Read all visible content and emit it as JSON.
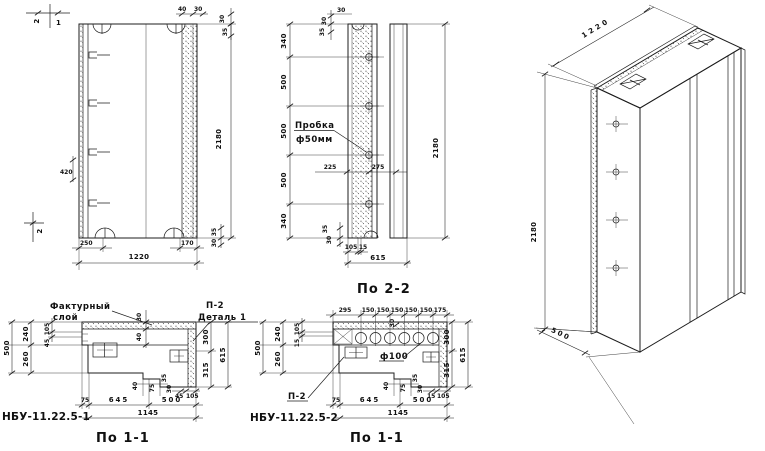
{
  "title": "Рабочий чертёж панели НБУ-11.22.5",
  "elevation": {
    "mark_2_top": "2",
    "mark_1_top": "1",
    "mark_2_bottom": "2",
    "dim_top_40": "40",
    "dim_top_30a": "30",
    "dim_top_30b": "30",
    "dim_top_35": "35",
    "dim_height": "2180",
    "dim_420": "420",
    "dim_250": "250",
    "dim_170": "170",
    "dim_1220": "1220",
    "dim_br_35": "35",
    "dim_br_30": "30"
  },
  "side": {
    "caption": "По 2-2",
    "plug_line1": "Пробка",
    "plug_line2": "ф50мм",
    "dim_top_30": "30",
    "dim_top_30r": "30",
    "dim_top_35": "35",
    "dim_340t": "340",
    "dim_500a": "500",
    "dim_500b": "500",
    "dim_500c": "500",
    "dim_340b": "340",
    "dim_225": "225",
    "dim_275": "275",
    "dim_bot_35": "35",
    "dim_bot_30": "30",
    "dim_105": "105",
    "dim_15": "15",
    "dim_615": "615",
    "dim_height": "2180"
  },
  "iso": {
    "dim_width": "1220",
    "dim_height": "2180",
    "dim_depth": "500"
  },
  "section1": {
    "code": "НБУ-11.22.5-1",
    "caption": "По 1-1",
    "texture_line1": "Фактурный",
    "texture_line2": "слой",
    "detail_ref": "П-2",
    "detail_label": "Деталь 1",
    "dim_l500": "500",
    "dim_l240": "240",
    "dim_l260": "260",
    "dim_l105": "105",
    "dim_l45": "45",
    "dim_t30": "30",
    "dim_t40": "40",
    "dim_r300": "300",
    "dim_r315": "315",
    "dim_r615": "615",
    "dim_s40": "40",
    "dim_s75": "75",
    "dim_s35": "35",
    "dim_s30": "30",
    "dim_s45": "45",
    "dim_s105": "105",
    "dim_b75": "75",
    "dim_b645": "645",
    "dim_b500": "500",
    "dim_b1145": "1145"
  },
  "section2": {
    "code": "НБУ-11.22.5-2",
    "caption": "По 1-1",
    "hole_label": "ф100",
    "detail_ref": "П-2",
    "dim_top": [
      "295",
      "150",
      "150",
      "150",
      "150",
      "150",
      "175"
    ],
    "dim_t30": "30",
    "dim_l500": "500",
    "dim_l240": "240",
    "dim_l260": "260",
    "dim_l105": "105",
    "dim_l15": "15",
    "dim_r300": "300",
    "dim_r315": "315",
    "dim_r615": "615",
    "dim_s40": "40",
    "dim_s75": "75",
    "dim_s35": "35",
    "dim_s30": "30",
    "dim_s15": "15",
    "dim_s105": "105",
    "dim_b75": "75",
    "dim_b645": "645",
    "dim_b500": "500",
    "dim_b1145": "1145"
  }
}
